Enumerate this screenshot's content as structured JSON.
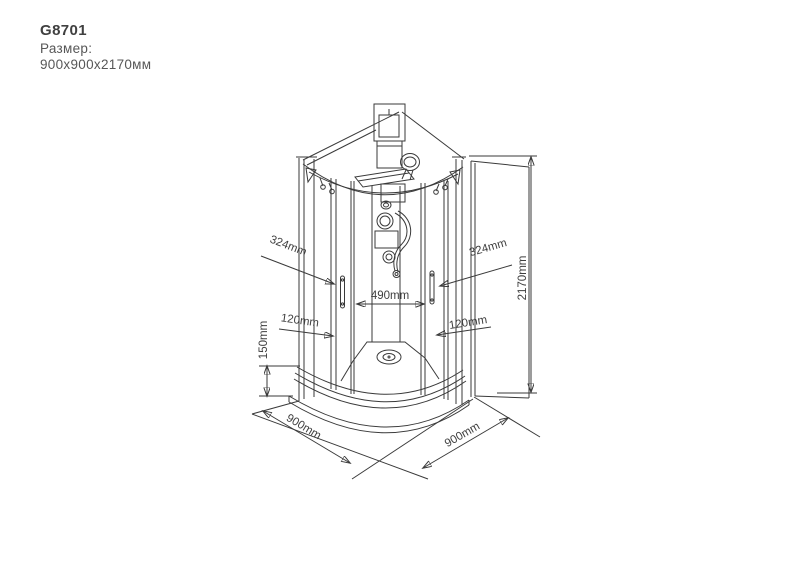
{
  "header": {
    "model": "G8701",
    "size_label": "Размер:",
    "size_value": "900x900x2170мм"
  },
  "diagram": {
    "type": "technical-drawing",
    "subject": "corner shower cabin, quarter-round, isometric line drawing",
    "dimensions": {
      "door_left": "324mm",
      "door_right": "324mm",
      "height": "2170mm",
      "center_opening": "490mm",
      "panel_left": "120mm",
      "panel_right": "120mm",
      "tray_height": "150mm",
      "side_left": "900mm",
      "side_right": "900mm"
    }
  },
  "colors": {
    "background": "#ffffff",
    "line": "#3a3a3a",
    "text": "#4a4a4a"
  }
}
